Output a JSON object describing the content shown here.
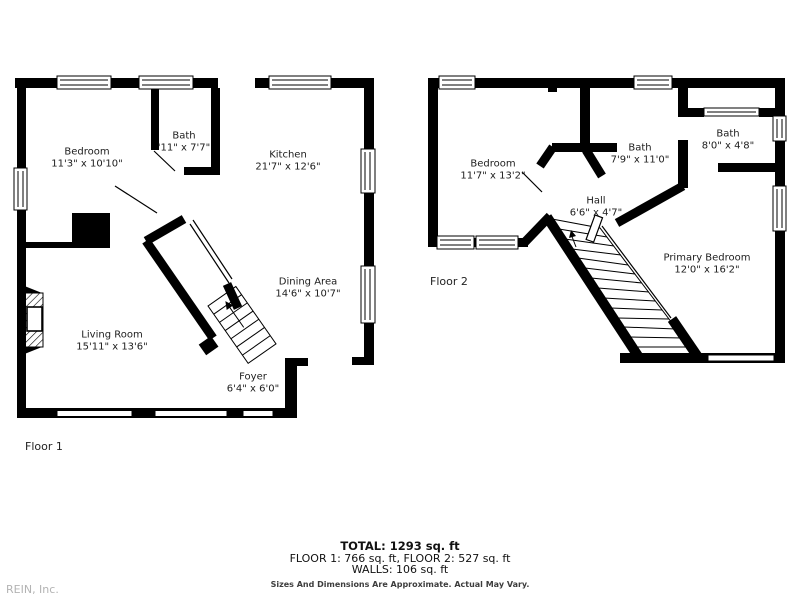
{
  "watermark": "REIN, Inc.",
  "floors": [
    {
      "label": "Floor 1",
      "rooms": [
        {
          "name": "Bedroom",
          "dims": "11'3\" x 10'10\""
        },
        {
          "name": "Bath",
          "dims": "'11\" x 7'7\""
        },
        {
          "name": "Kitchen",
          "dims": "21'7\" x 12'6\""
        },
        {
          "name": "Dining Area",
          "dims": "14'6\" x 10'7\""
        },
        {
          "name": "Living Room",
          "dims": "15'11\" x 13'6\""
        },
        {
          "name": "Foyer",
          "dims": "6'4\" x 6'0\""
        }
      ]
    },
    {
      "label": "Floor 2",
      "rooms": [
        {
          "name": "Bedroom",
          "dims": "11'7\" x 13'2\""
        },
        {
          "name": "Bath",
          "dims": "7'9\" x 11'0\""
        },
        {
          "name": "Bath",
          "dims": "8'0\" x 4'8\""
        },
        {
          "name": "Hall",
          "dims": "6'6\" x 4'7\""
        },
        {
          "name": "Primary Bedroom",
          "dims": "12'0\" x 16'2\""
        }
      ]
    }
  ],
  "summary": {
    "total": "TOTAL: 1293 sq. ft",
    "floor_breakdown": "FLOOR 1: 766 sq. ft, FLOOR 2: 527 sq. ft",
    "walls": "WALLS: 106 sq. ft",
    "disclaimer": "Sizes And Dimensions Are Approximate. Actual May Vary."
  },
  "colors": {
    "wall": "#000000",
    "background": "#ffffff",
    "text": "#1c1c1c",
    "watermark": "#b3b3b3"
  }
}
